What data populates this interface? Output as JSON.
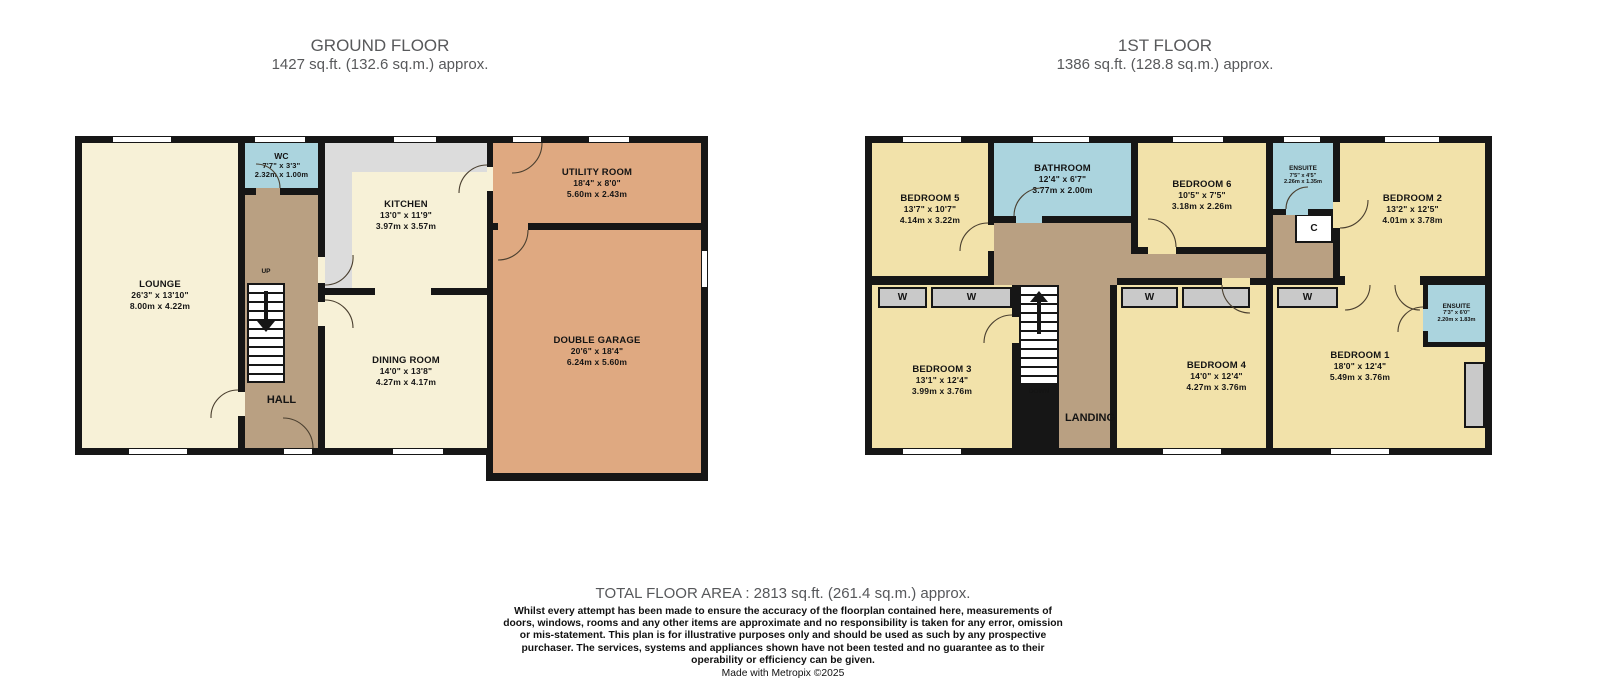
{
  "palette": {
    "wall": "#161616",
    "cream_room": "#f7f1d7",
    "yellow_room": "#f2e2aa",
    "wet_room_blue": "#abd4de",
    "hall_brown": "#b9a082",
    "garage_salmon": "#dfa981",
    "counter_gray": "#dcdcdc",
    "wardrobe_gray": "#c9c9c9",
    "title_text": "#58595b"
  },
  "ground_floor": {
    "title": "GROUND FLOOR",
    "subtitle": "1427 sq.ft. (132.6 sq.m.) approx.",
    "labels": {
      "hall": "HALL",
      "up": "UP"
    },
    "rooms": {
      "lounge": {
        "name": "LOUNGE",
        "imperial": "26'3\" x 13'10\"",
        "metric": "8.00m x 4.22m"
      },
      "wc": {
        "name": "WC",
        "imperial": "7'7\" x 3'3\"",
        "metric": "2.32m x 1.00m"
      },
      "kitchen": {
        "name": "KITCHEN",
        "imperial": "13'0\" x 11'9\"",
        "metric": "3.97m x 3.57m"
      },
      "utility": {
        "name": "UTILITY ROOM",
        "imperial": "18'4\" x 8'0\"",
        "metric": "5.60m x 2.43m"
      },
      "dining": {
        "name": "DINING ROOM",
        "imperial": "14'0\" x 13'8\"",
        "metric": "4.27m x 4.17m"
      },
      "garage": {
        "name": "DOUBLE GARAGE",
        "imperial": "20'6\" x 18'4\"",
        "metric": "6.24m x 5.60m"
      }
    }
  },
  "first_floor": {
    "title": "1ST FLOOR",
    "subtitle": "1386 sq.ft. (128.8 sq.m.) approx.",
    "labels": {
      "landing": "LANDING",
      "down": "DOWN",
      "wardrobe": "W",
      "cupboard": "C"
    },
    "rooms": {
      "bedroom5": {
        "name": "BEDROOM 5",
        "imperial": "13'7\" x 10'7\"",
        "metric": "4.14m x 3.22m"
      },
      "bathroom": {
        "name": "BATHROOM",
        "imperial": "12'4\" x 6'7\"",
        "metric": "3.77m x 2.00m"
      },
      "bedroom6": {
        "name": "BEDROOM 6",
        "imperial": "10'5\" x 7'5\"",
        "metric": "3.18m x 2.26m"
      },
      "ensuite_top": {
        "name": "ENSUITE",
        "imperial": "7'5\" x 4'5\"",
        "metric": "2.26m x 1.35m"
      },
      "bedroom2": {
        "name": "BEDROOM 2",
        "imperial": "13'2\" x 12'5\"",
        "metric": "4.01m x 3.78m"
      },
      "bedroom3": {
        "name": "BEDROOM 3",
        "imperial": "13'1\" x 12'4\"",
        "metric": "3.99m x 3.76m"
      },
      "bedroom4": {
        "name": "BEDROOM 4",
        "imperial": "14'0\" x 12'4\"",
        "metric": "4.27m x 3.76m"
      },
      "bedroom1": {
        "name": "BEDROOM 1",
        "imperial": "18'0\" x 12'4\"",
        "metric": "5.49m x 3.76m"
      },
      "ensuite_main": {
        "name": "ENSUITE",
        "imperial": "7'3\" x 6'0\"",
        "metric": "2.20m x 1.83m"
      }
    }
  },
  "footer": {
    "total": "TOTAL FLOOR AREA : 2813 sq.ft. (261.4 sq.m.) approx.",
    "disclaimer": "Whilst every attempt has been made to ensure the accuracy of the floorplan contained here, measurements of doors, windows, rooms and any other items are approximate and no responsibility is taken for any error, omission or mis-statement. This plan is for illustrative purposes only and should be used as such by any prospective purchaser. The services, systems and appliances shown have not been tested and no guarantee as to their operability or efficiency can be given.",
    "credit": "Made with Metropix ©2025"
  }
}
